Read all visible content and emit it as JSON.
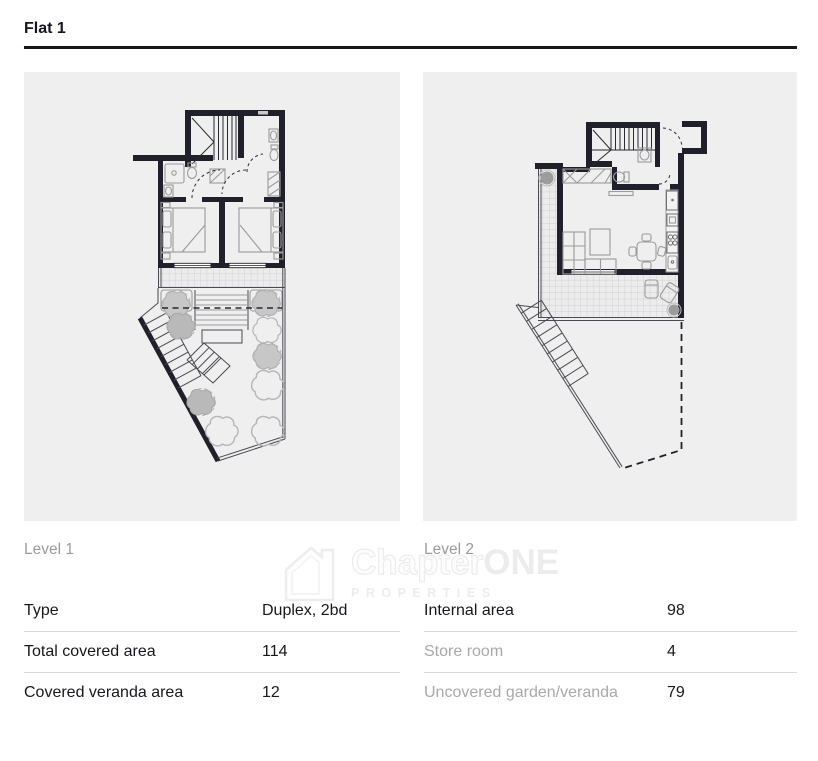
{
  "page": {
    "title": "Flat 1"
  },
  "plans": [
    {
      "label": "Level 1",
      "name": "floorplan-level-1"
    },
    {
      "label": "Level 2",
      "name": "floorplan-level-2"
    }
  ],
  "spec_tables": {
    "level1": {
      "rows": [
        {
          "label": "Type",
          "value": "Duplex, 2bd"
        },
        {
          "label": "Total covered area",
          "value": "114"
        },
        {
          "label": "Covered veranda area",
          "value": "12"
        }
      ]
    },
    "level2": {
      "rows": [
        {
          "label": "Internal area",
          "value": "98"
        },
        {
          "label": "Store room",
          "value": "4"
        },
        {
          "label": "Uncovered garden/veranda",
          "value": "79"
        }
      ]
    }
  },
  "watermark": {
    "brand_part1": "Chapter",
    "brand_part2": "ONE",
    "tagline": "PROPERTIES",
    "icon": "house-one-icon"
  },
  "colors": {
    "rule": "#16161e",
    "panel_bg": "#efefef",
    "text_dark": "#17171f",
    "text_muted": "#a9a9a9",
    "divider": "#dbdbdb",
    "wall": "#20202a",
    "watermark": "#ededed"
  }
}
